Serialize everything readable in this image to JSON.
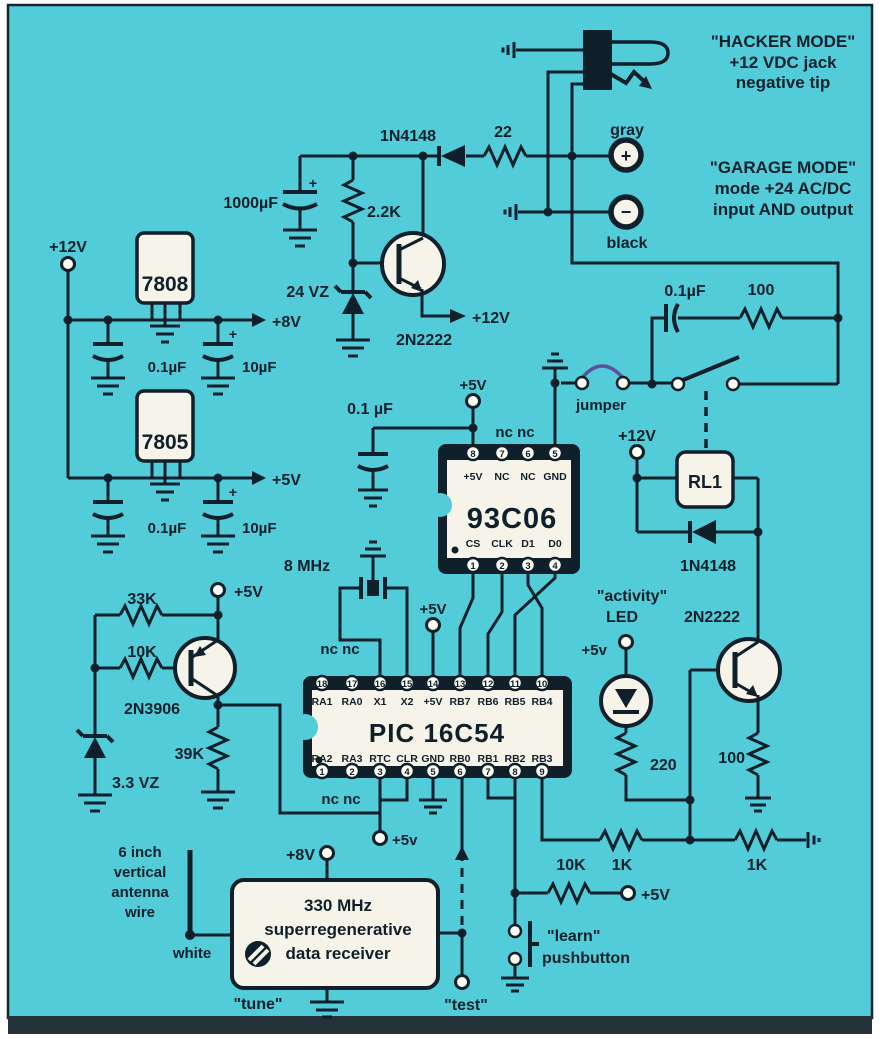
{
  "image_type": "scanned electronic schematic",
  "colors": {
    "background": "#52ccd8",
    "ink": "#10202b",
    "component_fill": "#f6f3e8",
    "jumper_wire": "#5b4fa0",
    "scan_strip": "#25323a"
  },
  "jack": {
    "hacker_lines": [
      "\"HACKER MODE\"",
      "+12 VDC jack",
      "negative tip"
    ],
    "gray": "gray",
    "black": "black",
    "plus": "+",
    "minus": "−",
    "garage_lines": [
      "\"GARAGE MODE\"",
      "mode +24 AC/DC",
      "input AND output"
    ]
  },
  "top_supply": {
    "diode": "1N4148",
    "series_res": "22",
    "filter_cap": "1000µF",
    "base_res": "2.2K",
    "zener": "24 VZ",
    "transistor": "2N2222",
    "v12_out": "+12V",
    "polarity": "+"
  },
  "regulators": {
    "v12_in": "+12V",
    "reg8": "7808",
    "reg5": "7805",
    "cap_small_a": "0.1µF",
    "cap_big_a": "10µF",
    "v8_out": "+8V",
    "cap_small_b": "0.1µF",
    "cap_big_b": "10µF",
    "v5_out": "+5V",
    "polarity": "+"
  },
  "eeprom": {
    "name": "93C06",
    "supply": "+5V",
    "bypass_cap": "0.1 µF",
    "nc_note": "nc nc",
    "pins_top_numbers": [
      "8",
      "7",
      "6",
      "5"
    ],
    "pins_top_labels": [
      "+5V",
      "NC",
      "NC",
      "GND"
    ],
    "pins_bottom_labels": [
      "CS",
      "CLK",
      "D1",
      "D0"
    ],
    "pins_bottom_numbers": [
      "1",
      "2",
      "3",
      "4"
    ]
  },
  "mode_switch": {
    "jumper": "jumper",
    "snubber_cap": "0.1µF",
    "snubber_res": "100"
  },
  "relay": {
    "supply": "+12V",
    "name": "RL1",
    "flyback_diode": "1N4148",
    "driver": "2N2222",
    "emitter_res": "100"
  },
  "indicator": {
    "label_line1": "\"activity\"",
    "label_line2": "LED",
    "supply": "+5v",
    "res": "220"
  },
  "mcu": {
    "name": "PIC 16C54",
    "crystal": "8 MHz",
    "supply_pin14": "+5V",
    "nc_top": "nc nc",
    "nc_bottom": "nc nc",
    "rtc_supply": "+5v",
    "pins_top_numbers": [
      "18",
      "17",
      "16",
      "15",
      "14",
      "13",
      "12",
      "11",
      "10"
    ],
    "pins_top_labels": [
      "RA1",
      "RA0",
      "X1",
      "X2",
      "+5V",
      "RB7",
      "RB6",
      "RB5",
      "RB4"
    ],
    "pins_bottom_labels": [
      "RA2",
      "RA3",
      "RTC",
      "CLR",
      "GND",
      "RB0",
      "RB1",
      "RB2",
      "RB3"
    ],
    "pins_bottom_numbers": [
      "1",
      "2",
      "3",
      "4",
      "5",
      "6",
      "7",
      "8",
      "9"
    ]
  },
  "brownout": {
    "res_33k": "33K",
    "res_10k": "10K",
    "transistor": "2N3906",
    "zener": "3.3 VZ",
    "res_39k": "39K",
    "supply": "+5V"
  },
  "receiver": {
    "box_lines": [
      "330 MHz",
      "superregenerative",
      "data receiver"
    ],
    "supply": "+8V",
    "antenna_lines": [
      "6 inch",
      "vertical",
      "antenna",
      "wire"
    ],
    "wire_color": "white",
    "tune": "\"tune\"",
    "test": "\"test\""
  },
  "learn_circuit": {
    "pullup": "10K",
    "base_res": "1K",
    "pulldown": "1K",
    "supply": "+5V",
    "label_line1": "\"learn\"",
    "label_line2": "pushbutton"
  }
}
